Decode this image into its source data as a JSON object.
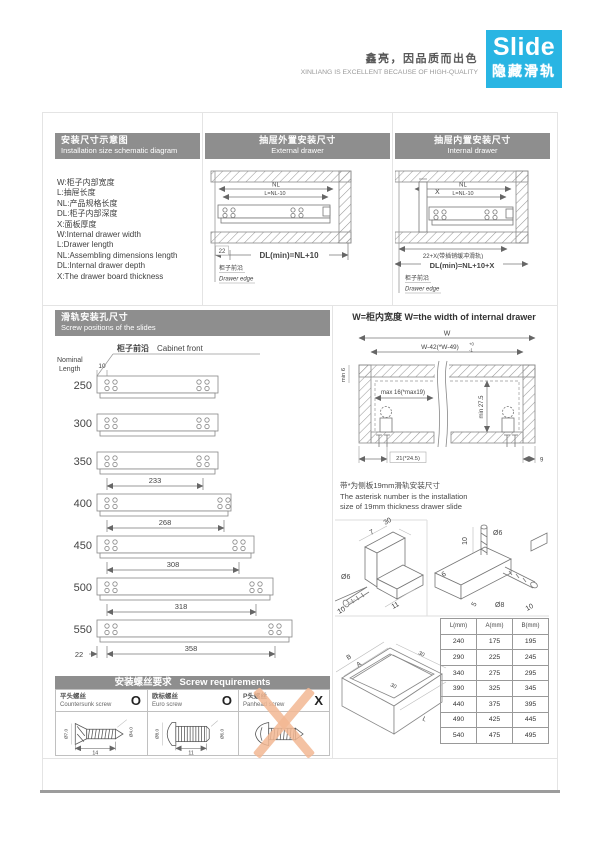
{
  "brand": {
    "logo_text": "Slide",
    "logo_sub": "隐藏滑轨",
    "tagline_cn": "鑫亮，因品质而出色",
    "tagline_en": "XINLIANG IS EXCELLENT BECAUSE OF HIGH-QUALITY",
    "accent_color": "#29b5e3",
    "header_gray": "#8e8e8e"
  },
  "schematic": {
    "title_cn": "安装尺寸示意图",
    "title_en": "Installation size schematic diagram",
    "defs": [
      "W:柜子内部宽度",
      "L:抽屉长度",
      "NL:产品规格长度",
      "DL:柜子内部深度",
      "X:面板厚度",
      "W:Internal drawer width",
      "L:Drawer length",
      "NL:Assembling dimensions length",
      "DL:Internal drawer depth",
      "X:The drawer board thickness"
    ]
  },
  "external": {
    "title_cn": "抽屉外置安装尺寸",
    "title_en": "External drawer",
    "dim_nl": "NL",
    "dim_l": "L=NL-10",
    "dim_front": "22",
    "dim_dl": "DL(min)=NL+10",
    "edge_cn": "柜子前沿",
    "edge_en": "Drawer edge"
  },
  "internal": {
    "title_cn": "抽屉内置安装尺寸",
    "title_en": "Internal drawer",
    "dim_nl": "NL",
    "dim_l": "L=NL-10",
    "dim_x": "X",
    "dim_front": "22+X(带插销缓冲滑轨)",
    "dim_dl": "DL(min)=NL+10+X",
    "edge_cn": "柜子前沿",
    "edge_en": "Drawer edge"
  },
  "positions": {
    "title_cn": "滑轨安装孔尺寸",
    "title_en": "Screw positions of the slides",
    "cabinet_cn": "柜子前沿",
    "cabinet_en": "Cabinet front",
    "nominal1": "Nominal",
    "nominal2": "Length",
    "dim_front": "10",
    "dim_back": "22",
    "rows": [
      {
        "len": "250",
        "span": ""
      },
      {
        "len": "300",
        "span": ""
      },
      {
        "len": "350",
        "span": "233"
      },
      {
        "len": "400",
        "span": "268"
      },
      {
        "len": "450",
        "span": "308"
      },
      {
        "len": "500",
        "span": "318"
      },
      {
        "len": "550",
        "span": "358"
      }
    ]
  },
  "width_sec": {
    "title": "W=柜内宽度   W=the width of internal drawer",
    "dim_w": "W",
    "dim_w2": "W-42(*W-49)",
    "tol_top": "+0",
    "tol_bot": "-1",
    "dim_min6": "min 6",
    "dim_max16": "max 16(*max19)",
    "dim_min275": "min 27.5",
    "dim_21": "21(*24.5)",
    "dim_9": "9",
    "note_cn": "带*为侧板19mm滑轨安装尺寸",
    "note_en1": "The asterisk number is the installation",
    "note_en2": "size of 19mm thickness drawer slide"
  },
  "iso": {
    "l30": "30",
    "l7": "7",
    "l_dia6": "Ø6",
    "l10": "10",
    "l11": "11",
    "r10": "10",
    "r_dia6": "Ø6",
    "r6": "6",
    "r5": "5",
    "r_dia8": "Ø8",
    "r10b": "10"
  },
  "box": {
    "b": "B",
    "a": "A",
    "t30a": "30",
    "t30b": "30",
    "l": "L"
  },
  "size_table": {
    "headers": [
      "L(mm)",
      "A(mm)",
      "B(mm)"
    ],
    "rows": [
      [
        "240",
        "175",
        "195"
      ],
      [
        "290",
        "225",
        "245"
      ],
      [
        "340",
        "275",
        "295"
      ],
      [
        "390",
        "325",
        "345"
      ],
      [
        "440",
        "375",
        "395"
      ],
      [
        "490",
        "425",
        "445"
      ],
      [
        "540",
        "475",
        "495"
      ]
    ]
  },
  "screws": {
    "title_cn": "安装螺丝要求",
    "title_en": "Screw requirements",
    "items": [
      {
        "cn": "平头螺丝",
        "en": "Countersunk screw",
        "mark": "O",
        "d_head": "Ø7.0",
        "d_shaft": "Ø4.0",
        "d_len": "14"
      },
      {
        "cn": "欧标螺丝",
        "en": "Euro screw",
        "mark": "O",
        "d_head": "Ø8.0",
        "d_shaft": "Ø6.0",
        "d_len": "11"
      },
      {
        "cn": "P头螺丝",
        "en": "Panhead screw",
        "mark": "X"
      }
    ]
  }
}
